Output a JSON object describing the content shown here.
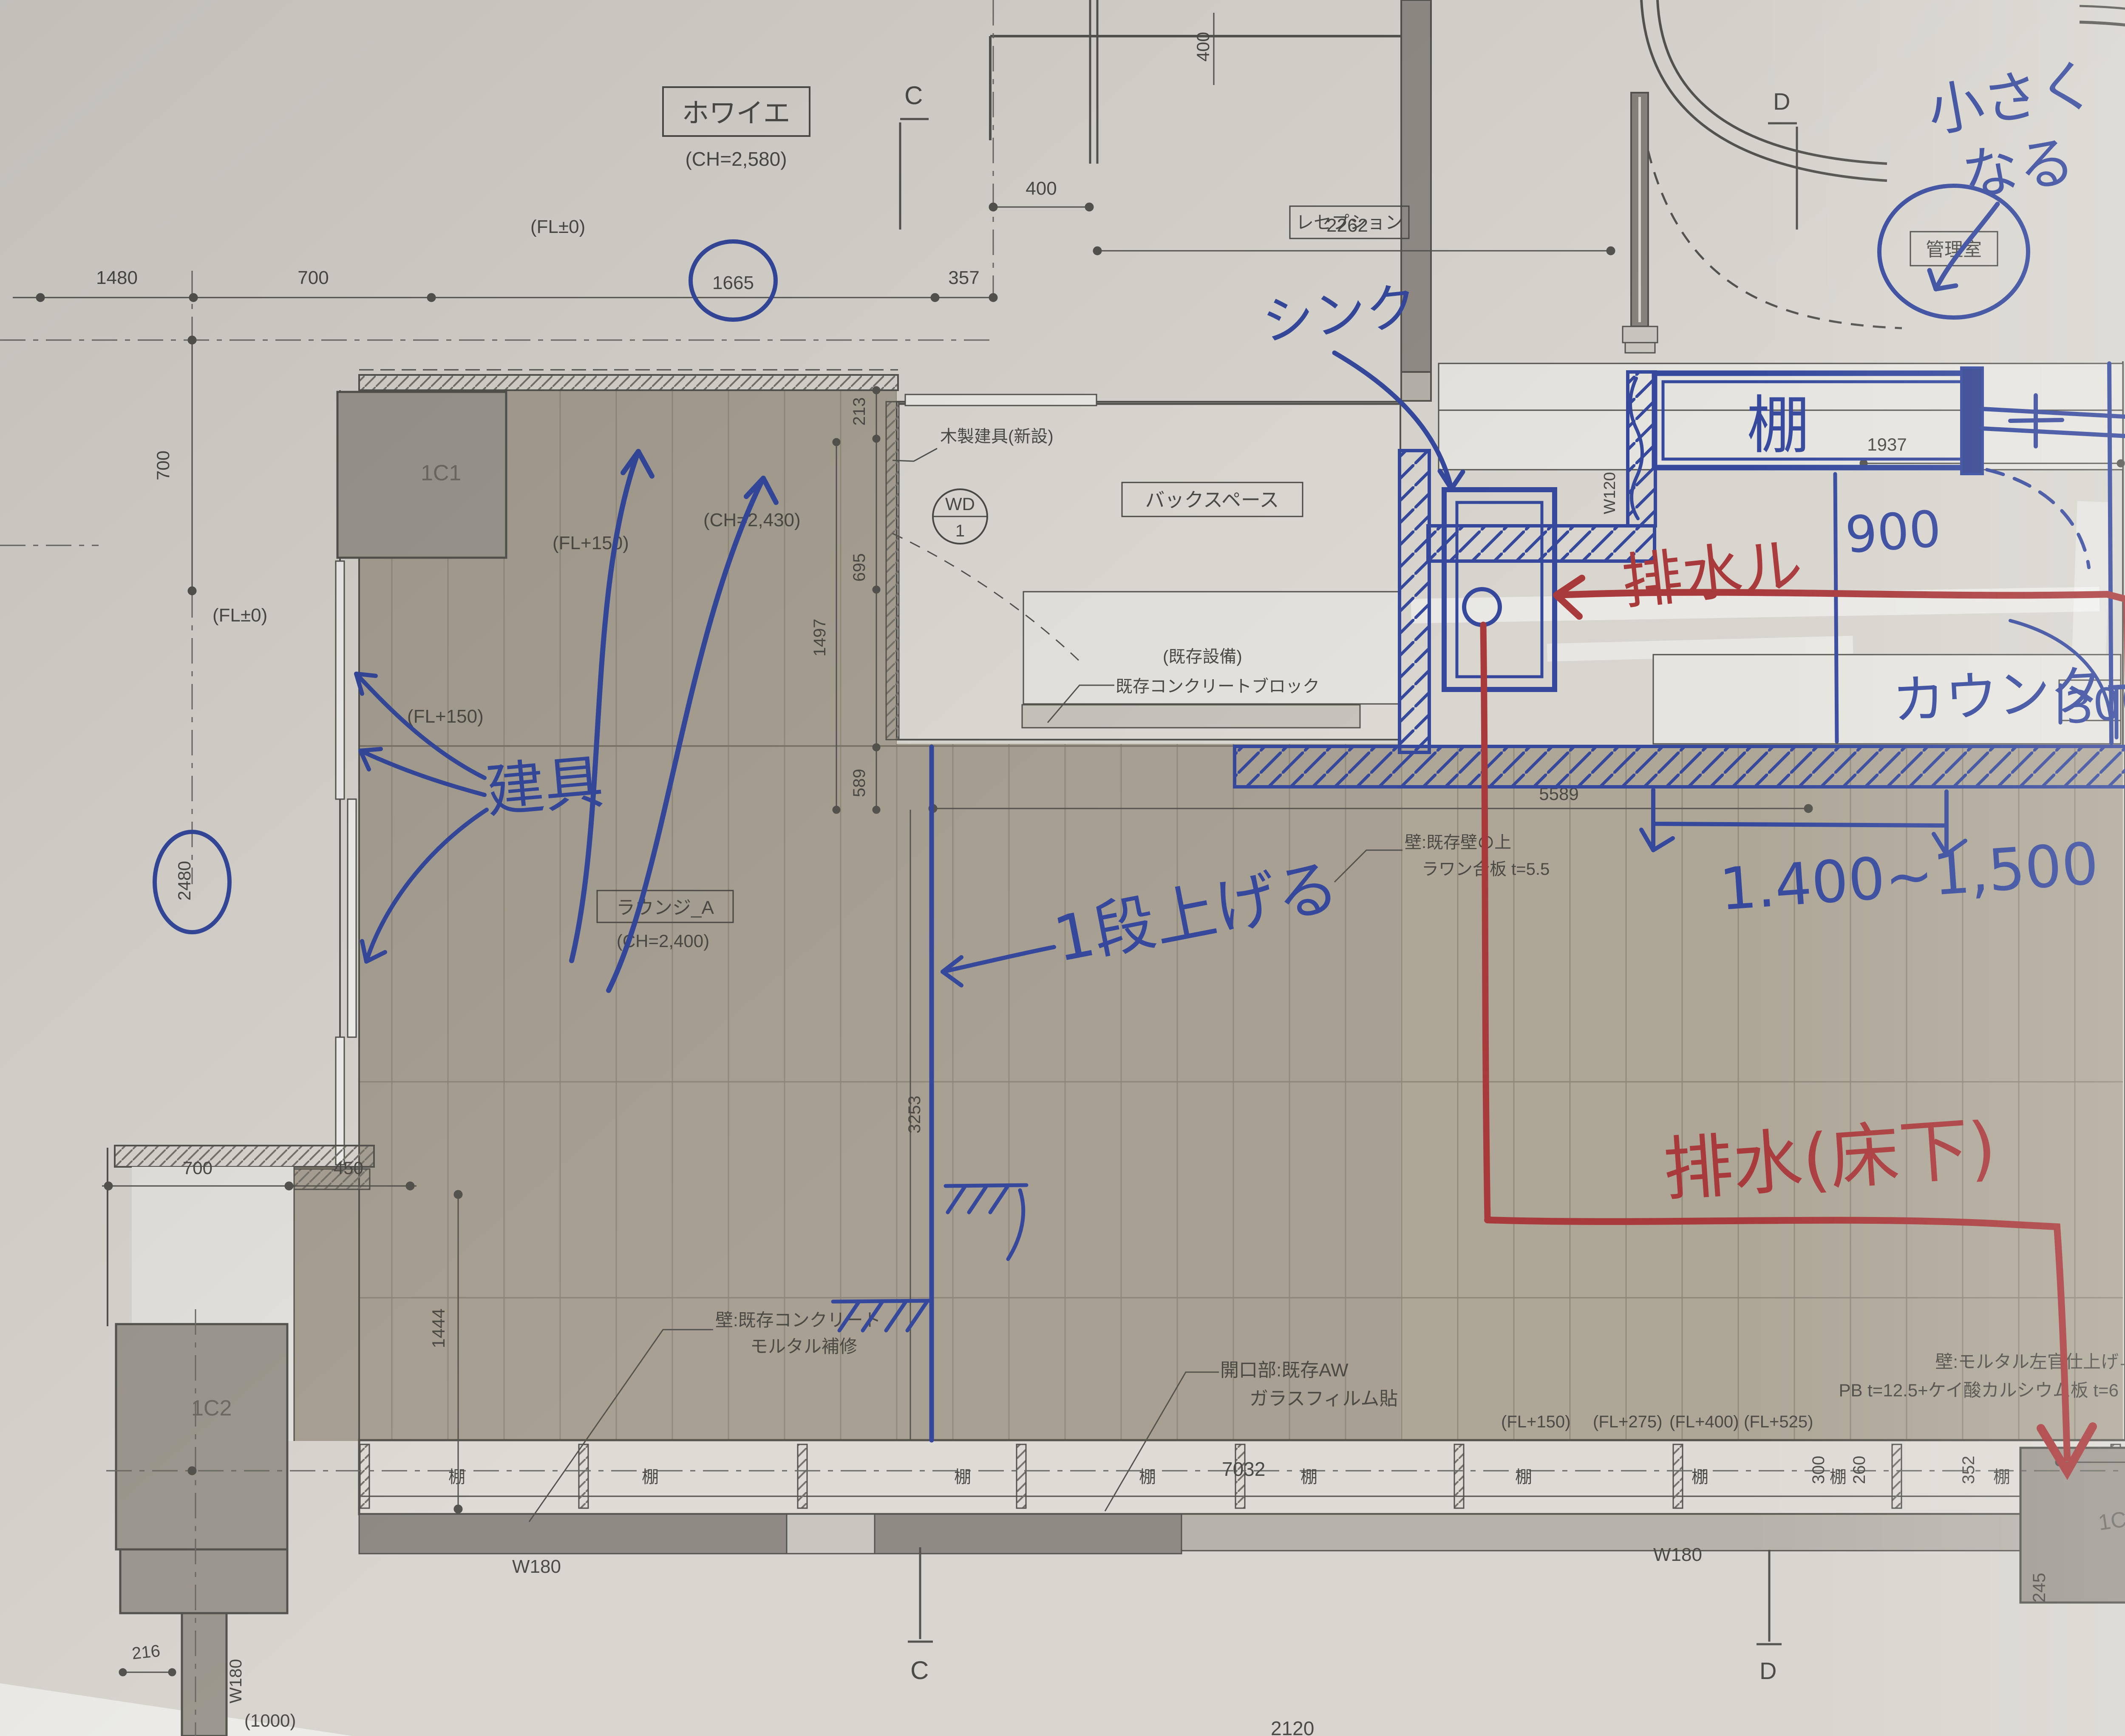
{
  "colors": {
    "paper": "#d8d5ce",
    "floor": "#a7a093",
    "floor_light": "#b3aca0",
    "plank": "#928b7c",
    "ink_blue": "#35489c",
    "ink_red": "#a93a3c",
    "print": "#4c4a45",
    "column": "#9d988f",
    "wall_dark": "#8f8b84",
    "band": "#b7b3ab"
  },
  "t": {
    "foyer": "ホワイエ",
    "foyer_ch": "(CH=2,580)",
    "reception": "レセプション",
    "admin": "管理室",
    "backspace": "バックスペース",
    "lounge": "ラウンジ_A",
    "lounge_ch": "(CH=2,400)",
    "wd": "WD",
    "wd1": "1",
    "wood_new": "木製建具(新設)",
    "exist_equip_paren": "(既存設備)",
    "exist_block": "既存コンクリートブロック",
    "wall_rawan1": "壁:既存壁の上",
    "wall_rawan2": "ラワン合板 t=5.5",
    "wall_conc1": "壁:既存コンクリート",
    "wall_conc2": "モルタル補修",
    "open1": "開口部:既存AW",
    "open2": "ガラスフィルム貼",
    "wall_mort1": "壁:モルタル左官仕上げ",
    "wall_mort2": "PB t=12.5+ケイ酸カルシウム板 t=6",
    "lowc1": "ローカウンター",
    "lowc2": "(ラワン合板)",
    "ee1": "既存",
    "ee2": "設備",
    "shelf": "棚",
    "c": "C",
    "d": "D",
    "a": "A",
    "c1": "1C1",
    "c2": "1C2",
    "c3": "1C3",
    "c4": "1C4",
    "fl0": "(FL±0)",
    "fl150": "(FL+150)",
    "fl275": "(FL+275)",
    "fl400": "(FL+400)",
    "fl525": "(FL+525)",
    "ch2430": "(CH=2,430)"
  },
  "dim": {
    "d1480": "1480",
    "d700a": "700",
    "d1665": "1665",
    "d357": "357",
    "d400h": "400",
    "d400v": "400",
    "d2262": "2262",
    "d213": "213",
    "d695": "695",
    "d1497": "1497",
    "d589": "589",
    "w120": "W120",
    "d1937": "1937",
    "d5589": "5589",
    "d3253": "3253",
    "d2480": "2480",
    "d700l": "700",
    "d700b": "700",
    "d450": "450",
    "d1444": "1444",
    "d7032": "7032",
    "d722": "722",
    "d300": "300",
    "d260": "260",
    "d352": "352",
    "d245": "245",
    "d770": "770",
    "d216": "216",
    "d1000": "(1000)",
    "d2120": "2120",
    "w180": "W180",
    "w120r": "W120",
    "d1670": "1670",
    "d2955": "2955"
  },
  "hb": {
    "small1": "小さく",
    "small2": "なる",
    "mente": "メンテ",
    "sink": "シンク",
    "shelf": "棚",
    "n900": "900",
    "counter": "カウンター",
    "n300": "300",
    "range": "1.400~1,500",
    "tategu": "建具",
    "step": "1段上げる"
  },
  "hr": {
    "route": "排水ル",
    "under": "排水(床下)"
  }
}
